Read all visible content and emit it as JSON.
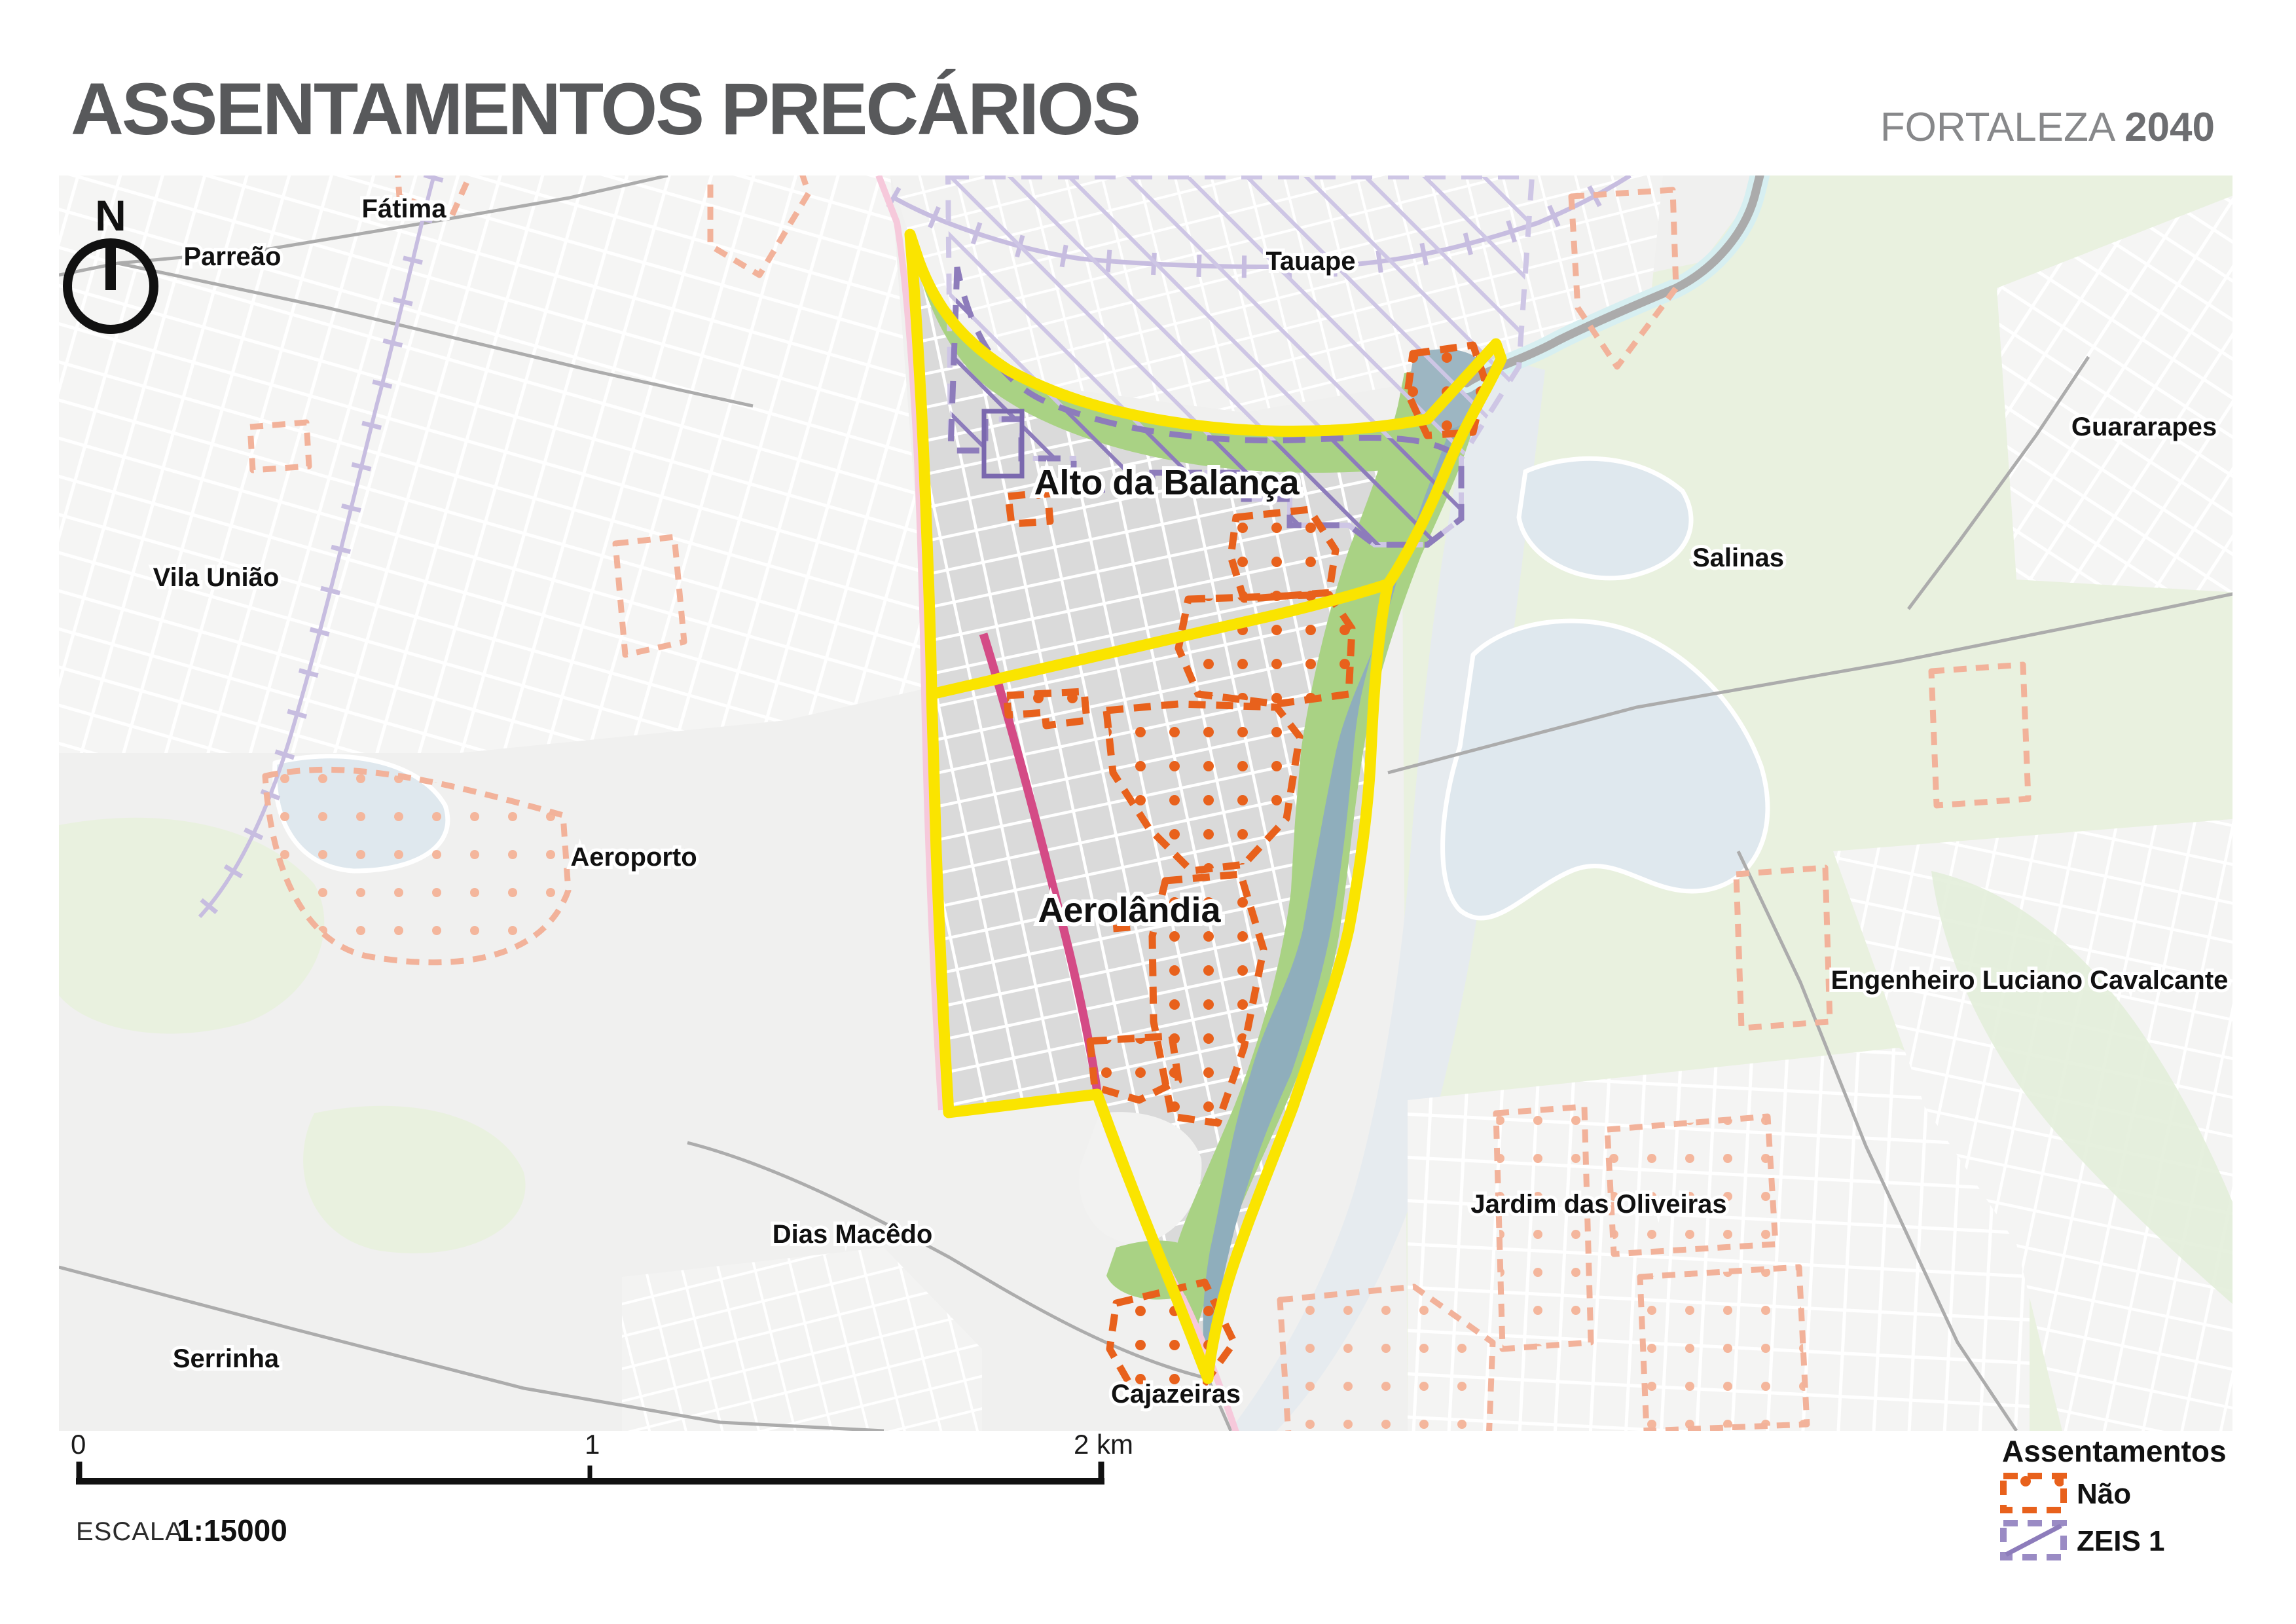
{
  "header": {
    "title": "ASSENTAMENTOS PRECÁRIOS",
    "brand_name": "FORTALEZA ",
    "brand_year": "2040"
  },
  "map": {
    "compass_label": "N",
    "place_labels": [
      {
        "id": "fatima",
        "text": "Fátima"
      },
      {
        "id": "parreao",
        "text": "Parreão"
      },
      {
        "id": "tauape",
        "text": "Tauape"
      },
      {
        "id": "vila-uniao",
        "text": "Vila União"
      },
      {
        "id": "guararapes",
        "text": "Guararapes"
      },
      {
        "id": "salinas",
        "text": "Salinas"
      },
      {
        "id": "aeroporto",
        "text": "Aeroporto"
      },
      {
        "id": "engenheiro-luciano-cavalcante",
        "text": "Engenheiro Luciano Cavalcante"
      },
      {
        "id": "alto-da-balanca",
        "text": "Alto da Balança"
      },
      {
        "id": "aerolandia",
        "text": "Aerolândia"
      },
      {
        "id": "jardim-das-oliveiras",
        "text": "Jardim das Oliveiras"
      },
      {
        "id": "dias-macedo",
        "text": "Dias Macêdo"
      },
      {
        "id": "serrinha",
        "text": "Serrinha"
      },
      {
        "id": "cajazeiras",
        "text": "Cajazeiras"
      }
    ]
  },
  "legend": {
    "title": "Assentamentos",
    "items": [
      {
        "label": "Não",
        "style": "orange-dotted"
      },
      {
        "label": "ZEIS 1",
        "style": "purple-hatched"
      }
    ]
  },
  "scalebar": {
    "tick0": "0",
    "tick1": "1",
    "tick2": "2 km",
    "escala_label": "ESCALA",
    "ratio": "1:15000"
  },
  "colors": {
    "boundary_yellow": "#FAE400",
    "settlement_orange": "#E8611C",
    "settlement_orange_faded": "#F2B29A",
    "zeis_purple": "#8D7CBB",
    "zeis_purple_faded": "#CEC6E5",
    "river_blue": "#8FAEBC",
    "riparian_green": "#A9D284",
    "pale_green": "#E9F1DF",
    "rail_magenta": "#D44B86",
    "rail_pink": "#F6C9DB",
    "block_gray": "#DADADA",
    "title_gray": "#58595B"
  }
}
